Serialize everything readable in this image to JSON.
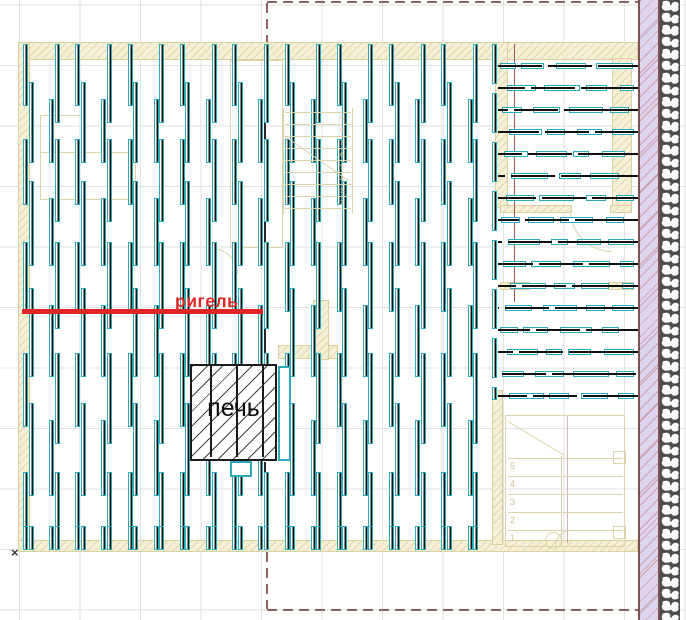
{
  "canvas": {
    "width": 686,
    "height": 620
  },
  "labels": {
    "girder": "ригель",
    "stove": "печь",
    "origin_marker": "×"
  },
  "colors": {
    "joist_teal": "#2aacb8",
    "joist_black": "#101010",
    "girder_red": "#e12525",
    "wall_cream_fill": "#f6f0d6",
    "wall_cream_line": "#dccfa0",
    "plan_faint": "#ddd3ab",
    "boundary_dash_maroon": "#8f6262",
    "insulation_fill": "#ded4ee",
    "insulation_hatch": "#c9908f",
    "stone_hatch_dark": "#4d4d4d",
    "stone_hatch_white": "#fafafa",
    "grid_line": "#e2e2e2"
  },
  "vertical_joists": {
    "x_start": 28,
    "spacing": 26.15,
    "count": 18,
    "y_top": 44,
    "y_bottom": 550,
    "pair_offset": 5.5,
    "seg_min": 62,
    "seg_var": 34,
    "overlap": 24
  },
  "edge_joist": {
    "x": 494,
    "y_top": 44,
    "y_bottom": 400,
    "seg": 40,
    "gap": 9
  },
  "horizontal_joists": {
    "y_start": 66,
    "spacing": 22,
    "count": 16,
    "x_left": 500,
    "x_right": 634
  },
  "main_stairs": {
    "numbers": [
      "5",
      "4",
      "3",
      "2",
      "1"
    ]
  },
  "inner_stairs": {
    "numbers": [
      "9",
      "8",
      "7",
      "6",
      "5",
      "4",
      "3",
      "2"
    ]
  }
}
